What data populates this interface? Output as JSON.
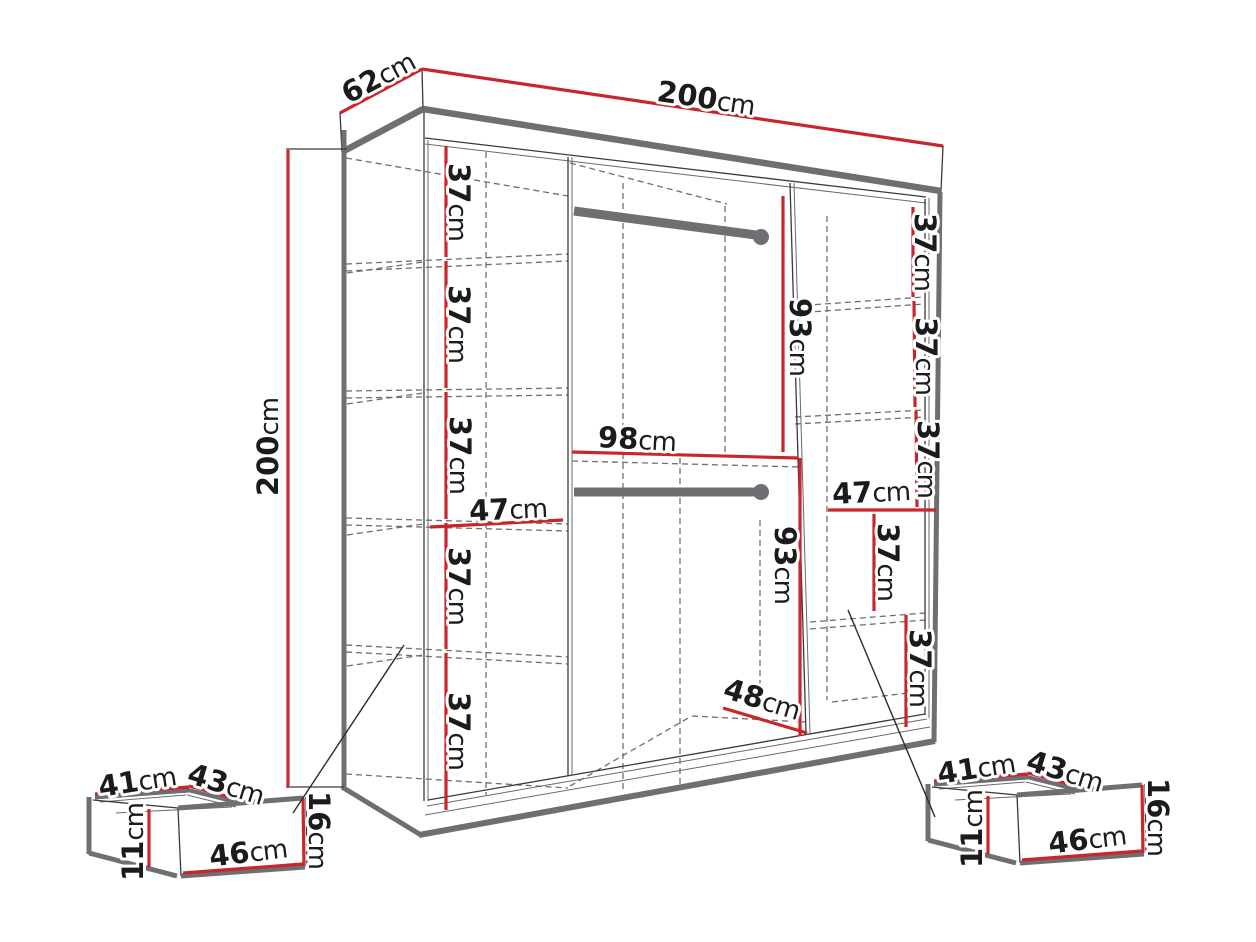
{
  "colors": {
    "accent_red": "#c9252b",
    "frame_gray": "#6e6f72",
    "line_black": "#2b2b2b",
    "dash_gray": "#6f6f6f",
    "background": "#ffffff"
  },
  "labels": {
    "depth": {
      "num": "62",
      "unit": "cm"
    },
    "width": {
      "num": "200",
      "unit": "cm"
    },
    "height": {
      "num": "200",
      "unit": "cm"
    },
    "left_shelf_1": {
      "num": "37",
      "unit": "cm"
    },
    "left_shelf_2": {
      "num": "37",
      "unit": "cm"
    },
    "left_shelf_3": {
      "num": "37",
      "unit": "cm"
    },
    "left_shelf_4": {
      "num": "37",
      "unit": "cm"
    },
    "left_shelf_5": {
      "num": "37",
      "unit": "cm"
    },
    "left_width": {
      "num": "47",
      "unit": "cm"
    },
    "center_upper_height": {
      "num": "93",
      "unit": "cm"
    },
    "center_width": {
      "num": "98",
      "unit": "cm"
    },
    "center_lower_height": {
      "num": "93",
      "unit": "cm"
    },
    "center_depth": {
      "num": "48",
      "unit": "cm"
    },
    "right_shelf_1": {
      "num": "37",
      "unit": "cm"
    },
    "right_shelf_2": {
      "num": "37",
      "unit": "cm"
    },
    "right_shelf_3": {
      "num": "37",
      "unit": "cm"
    },
    "right_width": {
      "num": "47",
      "unit": "cm"
    },
    "right_lower_shelf_1": {
      "num": "37",
      "unit": "cm"
    },
    "right_lower_shelf_2": {
      "num": "37",
      "unit": "cm"
    },
    "drawer_top_depth": {
      "num": "41",
      "unit": "cm"
    },
    "drawer_top_width": {
      "num": "43",
      "unit": "cm"
    },
    "drawer_front_width": {
      "num": "46",
      "unit": "cm"
    },
    "drawer_front_height": {
      "num": "16",
      "unit": "cm"
    },
    "drawer_side_height": {
      "num": "11",
      "unit": "cm"
    }
  }
}
